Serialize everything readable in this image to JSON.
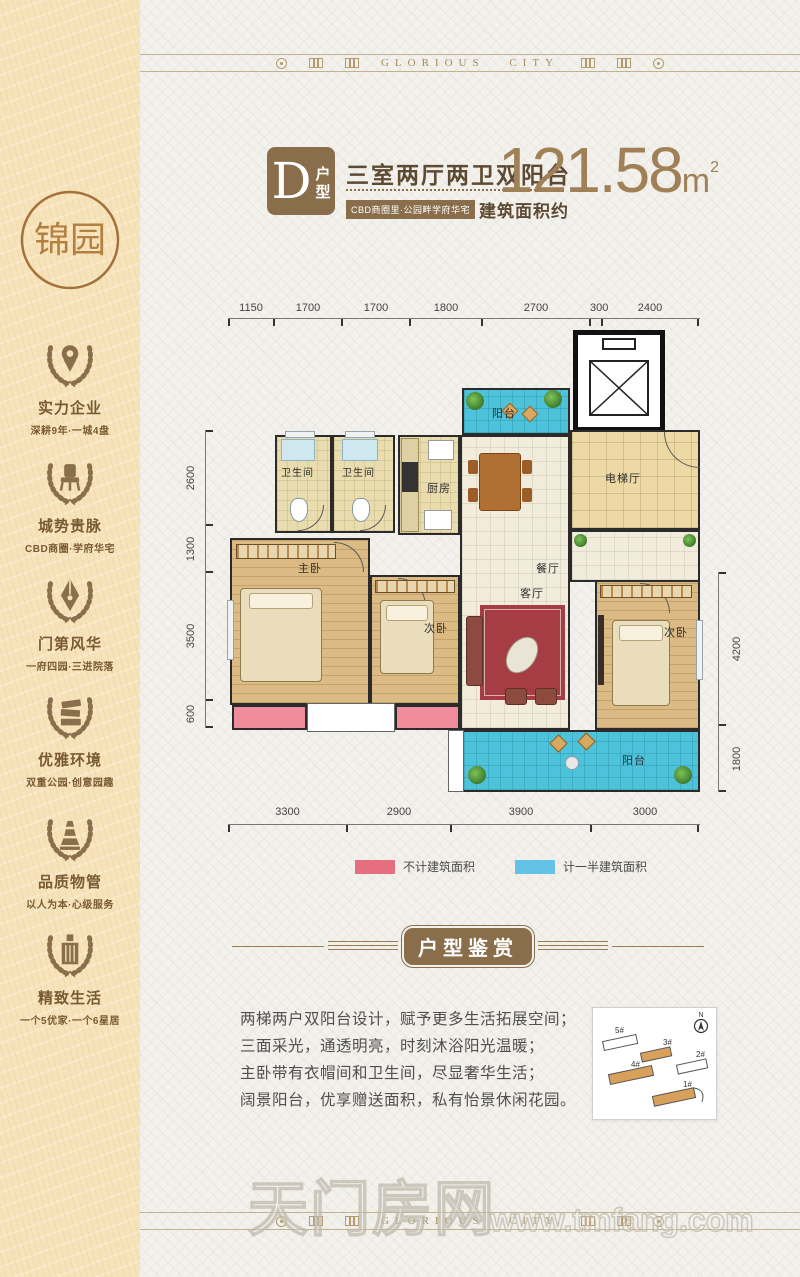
{
  "brand": {
    "name_en": "GLORIOUS CITY",
    "logo": "锦园"
  },
  "colors": {
    "brand_brown": "#8a6e4c",
    "accent_tan": "#a08057",
    "sidebar_bg": "#f7e3ba",
    "legend_pink": "#e56f7f",
    "legend_blue": "#62c3e6"
  },
  "sidebar": {
    "items": [
      {
        "icon": "location-pin",
        "title": "实力企业",
        "subtitle": "深耕9年·一城4盘"
      },
      {
        "icon": "throne",
        "title": "城势贵脉",
        "subtitle": "CBD商圈·学府华宅"
      },
      {
        "icon": "pen-nib",
        "title": "门第风华",
        "subtitle": "一府四园·三进院落"
      },
      {
        "icon": "books",
        "title": "优雅环境",
        "subtitle": "双重公园·创意园趣"
      },
      {
        "icon": "fountain",
        "title": "品质物管",
        "subtitle": "以人为本·心级服务"
      },
      {
        "icon": "building",
        "title": "精致生活",
        "subtitle": "一个5优家·一个6星居"
      }
    ]
  },
  "header": {
    "unit_letter": "D",
    "unit_word_1": "户",
    "unit_word_2": "型",
    "layout": "三室两厅两卫双阳台",
    "tagline": "CBD商圈里·公园畔学府华宅",
    "area_label": "建筑面积约",
    "area_value": "121.58",
    "area_unit": "m",
    "area_exp": "2"
  },
  "floorplan": {
    "dims_top": [
      "1150",
      "1700",
      "1700",
      "1800",
      "2700",
      "300",
      "2400"
    ],
    "dims_bottom": [
      "3300",
      "2900",
      "3900",
      "3000"
    ],
    "dims_left": [
      "2600",
      "1300",
      "3500",
      "600"
    ],
    "dims_right": [
      "4200",
      "1800"
    ],
    "rooms": {
      "bath1": "卫生间",
      "bath2": "卫生间",
      "kitchen": "厨房",
      "balcony_top": "阳台",
      "elevator_hall": "电梯厅",
      "dining": "餐厅",
      "master": "主卧",
      "bed2": "次卧",
      "living": "客厅",
      "bed3": "次卧",
      "balcony_bottom": "阳台"
    },
    "legend": [
      {
        "label": "不计建筑面积",
        "color": "#e56f7f"
      },
      {
        "label": "计一半建筑面积",
        "color": "#62c3e6"
      }
    ]
  },
  "section": {
    "title": "户型鉴赏"
  },
  "description": {
    "lines": [
      "两梯两户双阳台设计，赋予更多生活拓展空间；",
      "三面采光，通透明亮，时刻沐浴阳光温暖；",
      "主卧带有衣帽间和卫生间，尽显奢华生活；",
      "阔景阳台，优享赠送面积，私有怡景休闲花园。"
    ]
  },
  "sitemap": {
    "compass": "N",
    "buildings": [
      "5#",
      "3#",
      "2#",
      "4#",
      "1#"
    ]
  },
  "watermark": {
    "site": "天门房网",
    "domain": "www.tmfang.com"
  }
}
